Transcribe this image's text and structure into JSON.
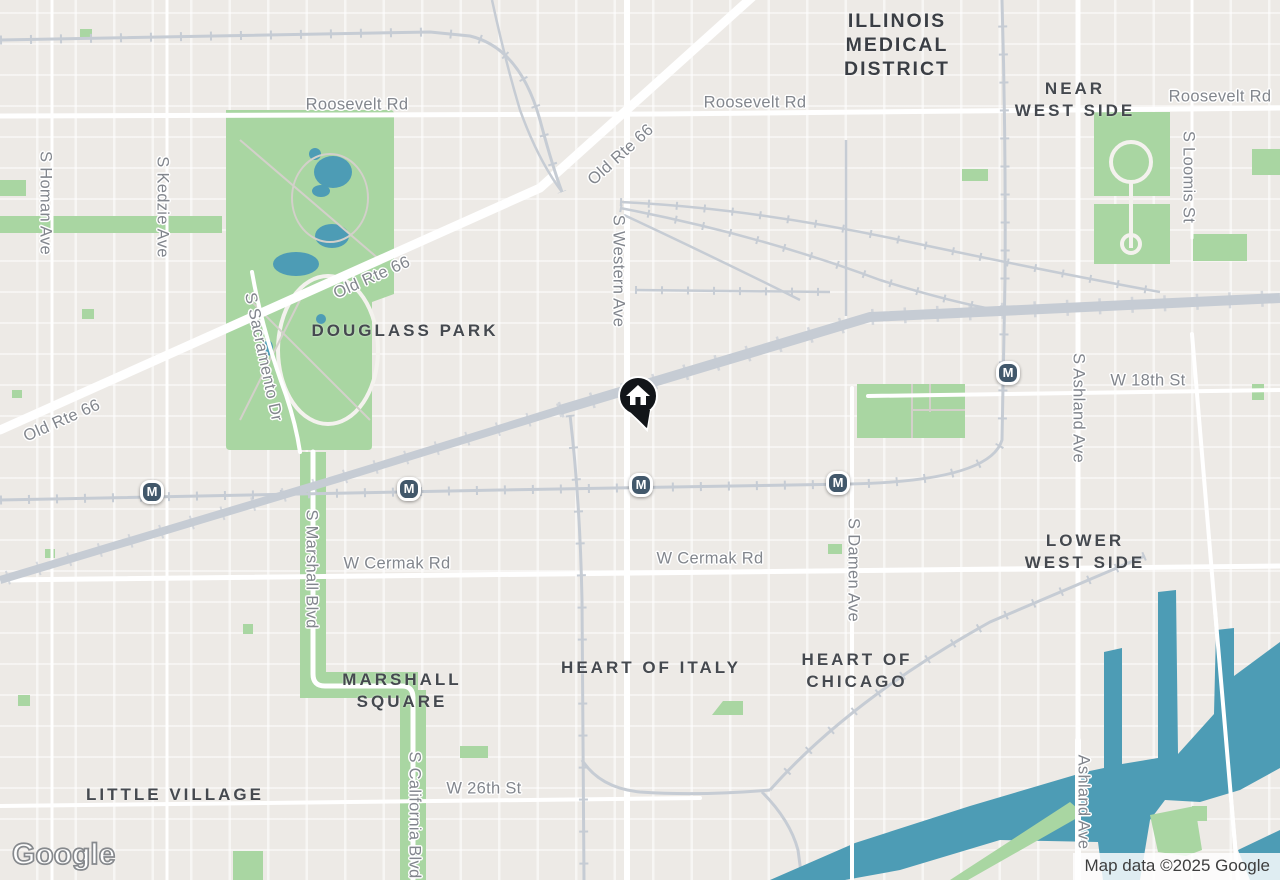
{
  "colors": {
    "land": "#edeae6",
    "road": "#ffffff",
    "park": "#a9d6a2",
    "water": "#4d9cb5",
    "rail": "#c6ccd4",
    "marker_bg": "#42586b",
    "pin": "#121519",
    "road_label": "#82868d",
    "area_label": "#45494f",
    "district_label": "#3a3e44",
    "attr_text": "#3e3e3e"
  },
  "roads": {
    "roosevelt": "Roosevelt Rd",
    "old_route": "Old Rte 66",
    "homan": "S Homan Ave",
    "kedzie": "S Kedzie Ave",
    "sacramento": "S Sacramento Dr",
    "western": "S Western Ave",
    "loomis": "S Loomis St",
    "ashland": "S Ashland Ave",
    "ashland_south": "Ashland Ave",
    "w18": "W 18th St",
    "cermak": "W Cermak Rd",
    "marshall": "S Marshall Blvd",
    "damen": "S Damen Ave",
    "california": "S California Blvd",
    "w26": "W 26th St"
  },
  "areas": {
    "imd": [
      "ILLINOIS",
      "MEDICAL",
      "DISTRICT"
    ],
    "near_west": [
      "NEAR",
      "WEST SIDE"
    ],
    "lower_west": [
      "LOWER",
      "WEST SIDE"
    ],
    "marshall_square": [
      "MARSHALL",
      "SQUARE"
    ],
    "heart_chicago": [
      "HEART OF",
      "CHICAGO"
    ],
    "heart_italy": "HEART OF ITALY",
    "little_village": "LITTLE VILLAGE",
    "douglass_park": "DOUGLASS PARK"
  },
  "transit": {
    "label": "M"
  },
  "footer": {
    "logo": "Google",
    "attribution": "Map data ©2025 Google"
  }
}
